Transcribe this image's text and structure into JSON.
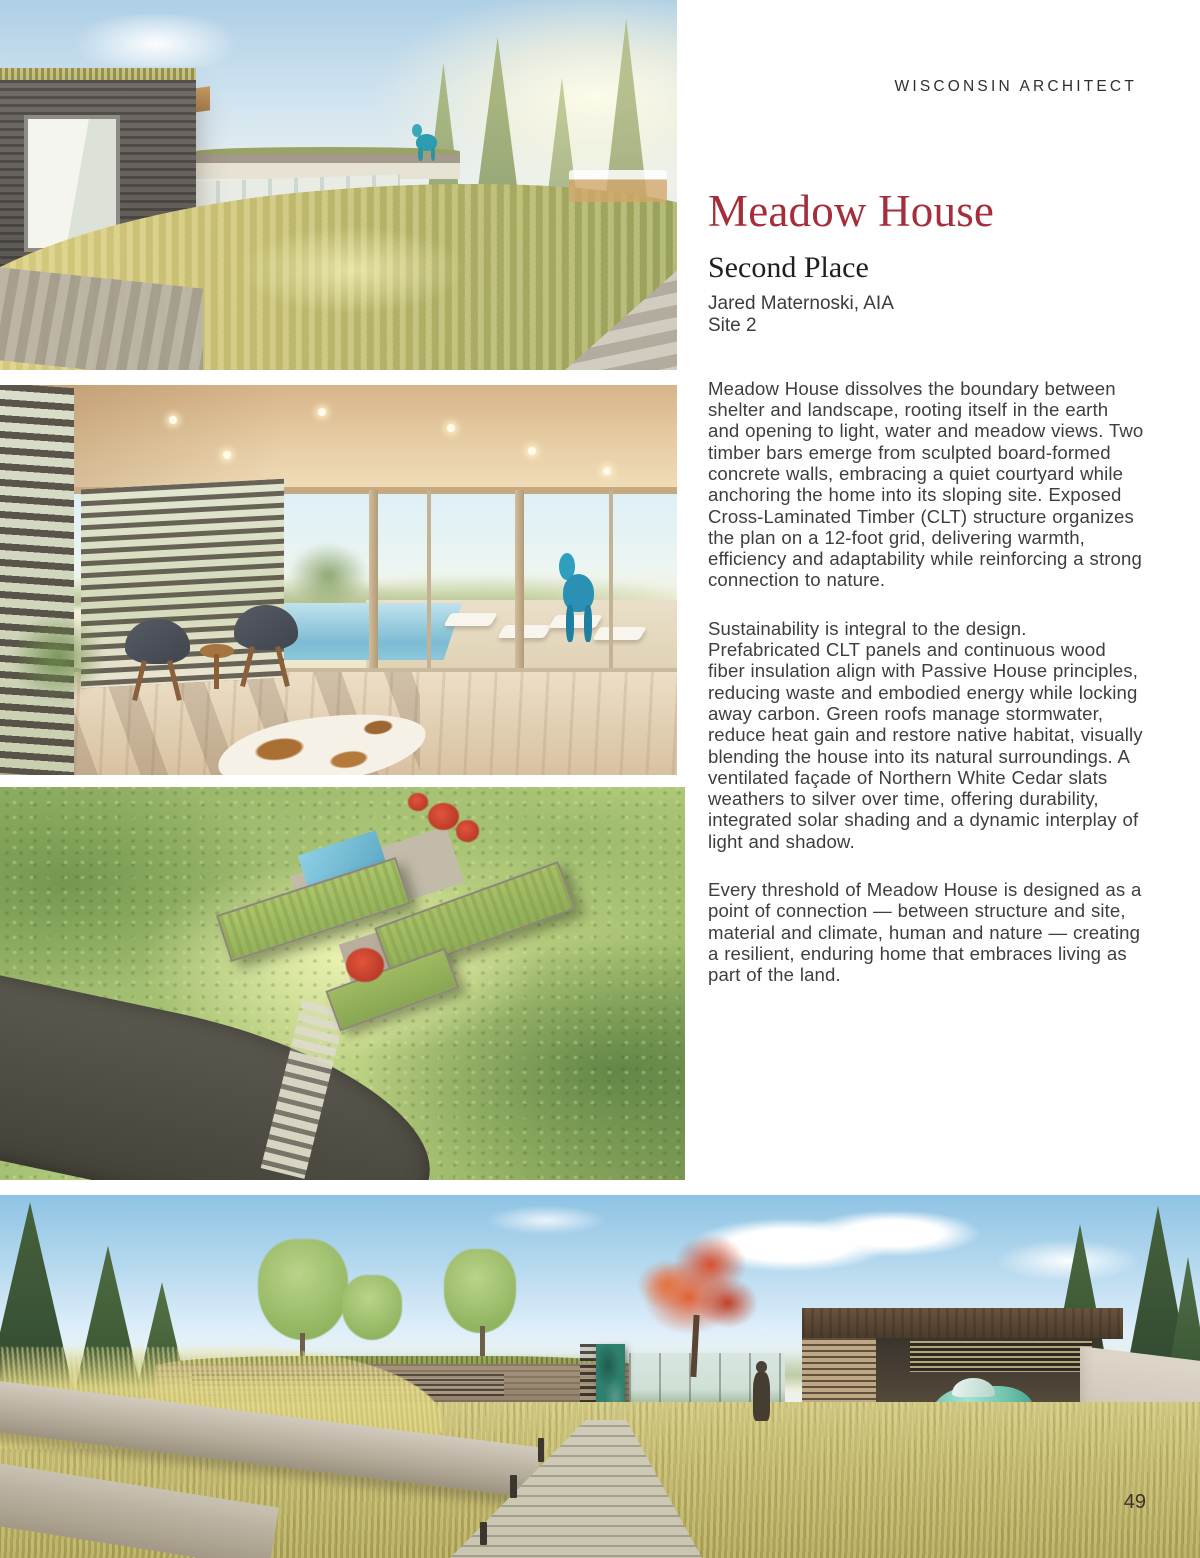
{
  "page": {
    "header": "WISCONSIN ARCHITECT",
    "page_number": "49"
  },
  "article": {
    "title": "Meadow House",
    "award": "Second Place",
    "architect": "Jared Maternoski, AIA",
    "site": "Site 2",
    "paragraphs": [
      "Meadow House dissolves the boundary between shelter and landscape, rooting itself in the earth and opening to light, water and meadow views. Two timber bars emerge from sculpted board-formed concrete walls, embracing a quiet courtyard while anchoring the home into its sloping site. Exposed Cross-Laminated Timber (CLT) structure organizes the plan on a 12-foot grid, delivering warmth, efficiency and adaptability while reinforcing a strong connection to nature.",
      "Sustainability is integral to the design. Prefabricated CLT panels and continuous wood fiber insulation align with Passive House principles, reducing waste and embodied energy while locking away carbon. Green roofs manage stormwater, reduce heat gain and restore native habitat, visually blending the house into its natural surroundings. A ventilated façade of Northern White Cedar slats weathers to silver over time, offering durability, integrated solar shading and a dynamic interplay of light and shadow.",
      "Every threshold of Meadow House is designed as a point of connection — between structure and site, material and climate, human and nature — creating a resilient, enduring home that embraces living as part of the land."
    ]
  },
  "figures": {
    "hero": "Exterior rendering: timber volumes with meadow green roof, balloon-dog sculpture and sunlit pines",
    "interior": "Interior rendering: timber room opening through glass walls to a pool terrace with lounge chairs",
    "aerial": "Aerial rendering: green-roofed house bars set into a wooded hillside beside a curving drive",
    "entry": "Exterior rendering: stone entry path through meadow grasses to a patinated door and carport with a vintage car"
  },
  "colors": {
    "accent_red": "#A62E3A",
    "body_text": "#3E3E3E",
    "header_text": "#2F2F2F",
    "door_teal": "#2F7F6E",
    "beetle_teal": "#6FC0AA",
    "page_number": "#3A3428"
  }
}
